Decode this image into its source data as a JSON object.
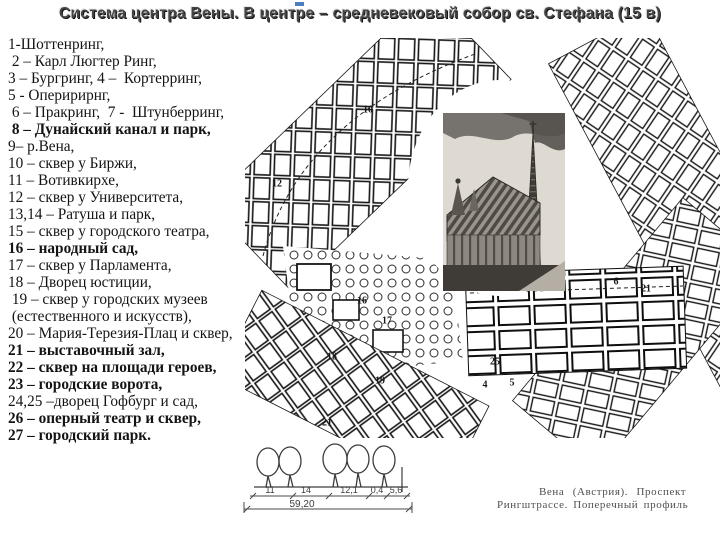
{
  "title": {
    "text": "Система центра Вены. В центре – средневековый собор св. Стефана (15 в)"
  },
  "legend": {
    "lines": [
      {
        "text": "1-Шоттенринг,",
        "bold": false
      },
      {
        "text": " 2 – Карл Люгтер Ринг,",
        "bold": false
      },
      {
        "text": "3 – Бургринг, 4 –  Кортерринг,",
        "bold": false
      },
      {
        "text": "5 - Оперирирнг,",
        "bold": false
      },
      {
        "text": " 6 – Пракринг,  7 -  Штунберринг,",
        "bold": false
      },
      {
        "text": " 8 – Дунайский канал и парк,",
        "bold": true
      },
      {
        "text": "9– р.Вена,",
        "bold": false
      },
      {
        "text": "10 – сквер у Биржи,",
        "bold": false
      },
      {
        "text": "11 – Вотивкирхе,",
        "bold": false
      },
      {
        "text": "12 – сквер у Университета,",
        "bold": false
      },
      {
        "text": "13,14 – Ратуша и парк,",
        "bold": false
      },
      {
        "text": "15 – сквер у городского театра,",
        "bold": false
      },
      {
        "text": "16 – народный сад,",
        "bold": true
      },
      {
        "text": "17 – сквер у Парламента,",
        "bold": false
      },
      {
        "text": "18 – Дворец юстиции,",
        "bold": false
      },
      {
        "text": " 19 – сквер у городских музеев",
        "bold": false
      },
      {
        "text": " (естественного и искусств),",
        "bold": false
      },
      {
        "text": "20 – Мария-Терезия-Плац и сквер,",
        "bold": false
      },
      {
        "text": "21 – выставочный зал,",
        "bold": true
      },
      {
        "text": "22 – сквер на площади героев,",
        "bold": true
      },
      {
        "text": "23 – городские ворота,",
        "bold": true
      },
      {
        "text": "24,25 –дворец Гофбург и сад,",
        "bold": false
      },
      {
        "text": "26 – оперный театр и сквер,",
        "bold": true
      },
      {
        "text": "27 – городский парк.",
        "bold": true
      }
    ]
  },
  "map": {
    "labels": [
      {
        "t": "10",
        "x": 368,
        "y": 110
      },
      {
        "t": "12",
        "x": 277,
        "y": 184
      },
      {
        "t": "16",
        "x": 362,
        "y": 301
      },
      {
        "t": "17",
        "x": 387,
        "y": 321
      },
      {
        "t": "18",
        "x": 332,
        "y": 357
      },
      {
        "t": "19",
        "x": 380,
        "y": 381
      },
      {
        "t": "21",
        "x": 327,
        "y": 423
      },
      {
        "t": "25",
        "x": 495,
        "y": 362
      },
      {
        "t": "4",
        "x": 485,
        "y": 385
      },
      {
        "t": "5",
        "x": 512,
        "y": 383
      },
      {
        "t": "6",
        "x": 616,
        "y": 282
      },
      {
        "t": "21",
        "x": 646,
        "y": 289
      }
    ]
  },
  "profile": {
    "dims": [
      "11",
      "14",
      "12,1",
      "0,4",
      "5,6"
    ],
    "total": "59,20"
  },
  "caption": {
    "line1": "Вена (Австрия). Проспект",
    "line2": "Рингштрассе. Поперечный профиль"
  },
  "colors": {
    "accent_blue": "#4a7ebf",
    "ink": "#1a1a1a"
  }
}
